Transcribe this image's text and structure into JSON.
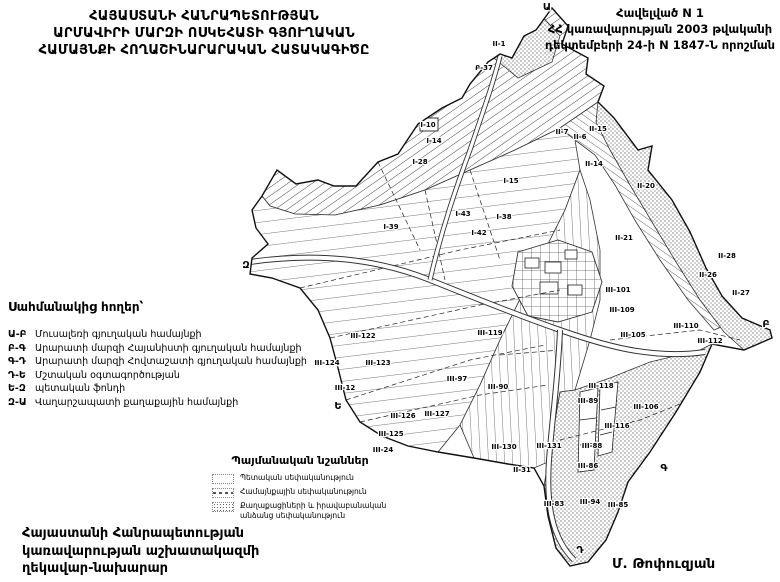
{
  "header": {
    "title_lines": [
      "ՀԱՅԱՍՏԱՆԻ ՀԱՆՐԱՊԵՏՈՒԹՅԱՆ",
      "ԱՐՄԱՎԻՐԻ ՄԱՐԶԻ ՈՍԿԵՀԱՏԻ ԳՅՈՒՂԱԿԱՆ",
      "ՀԱՄԱՅՆՔԻ ՀՈՂԱՇԻՆԱՐԱՐԱԿԱՆ ՀԱՏԱԿԱԳԻԾԸ"
    ],
    "annex_lines": [
      "Հավելված N 1",
      "ՀՀ կառավարության 2003 թվականի",
      "դեկտեմբերի 24-ի N 1847-Ն որոշման"
    ]
  },
  "border_legend": {
    "heading": "Սահմանակից հողեր՝",
    "items": [
      {
        "code": "Ա-Բ",
        "label": "Մուսալեռի գյուղական համայնքի"
      },
      {
        "code": "Բ-Գ",
        "label": "Արարատի մարզի Հայանիստի գյուղական համայնքի"
      },
      {
        "code": "Գ-Դ",
        "label": "Արարատի մարզի Հովտաշատի գյուղական համայնքի"
      },
      {
        "code": "Դ-Ե",
        "label": "Մշտական օգտագործության"
      },
      {
        "code": "Ե-Զ",
        "label": "պետական ֆոնդի"
      },
      {
        "code": "Զ-Ա",
        "label": "Վաղարշապատի քաղաքային համայնքի"
      }
    ]
  },
  "signs_legend": {
    "heading": "Պայմանական նշաններ",
    "items": [
      {
        "swatch": "state",
        "label": "Պետական սեփականություն"
      },
      {
        "swatch": "community",
        "label": "Համայնքային սեփականություն"
      },
      {
        "swatch": "private",
        "label": "Քաղաքացիների և իրավաբանական անձանց սեփականություն"
      }
    ]
  },
  "footer": {
    "left_lines": [
      "Հայաստանի Հանրապետության",
      "կառավարության աշխատակազմի",
      "ղեկավար-նախարար"
    ],
    "signature": "Մ. Թոփուզյան"
  },
  "map": {
    "ink_color": "#1a1a1a",
    "parcel_labels": [
      {
        "t": "II-1",
        "x": 499,
        "y": 46
      },
      {
        "t": "Բ-37",
        "x": 484,
        "y": 70
      },
      {
        "t": "I-10",
        "x": 428,
        "y": 127
      },
      {
        "t": "I-14",
        "x": 434,
        "y": 143
      },
      {
        "t": "I-28",
        "x": 420,
        "y": 164
      },
      {
        "t": "I-15",
        "x": 511,
        "y": 183
      },
      {
        "t": "I-43",
        "x": 463,
        "y": 216
      },
      {
        "t": "I-38",
        "x": 504,
        "y": 219
      },
      {
        "t": "I-42",
        "x": 479,
        "y": 235
      },
      {
        "t": "I-39",
        "x": 391,
        "y": 229
      },
      {
        "t": "II-7",
        "x": 562,
        "y": 134
      },
      {
        "t": "II-6",
        "x": 580,
        "y": 139
      },
      {
        "t": "II-15",
        "x": 598,
        "y": 131
      },
      {
        "t": "II-14",
        "x": 594,
        "y": 166
      },
      {
        "t": "II-20",
        "x": 646,
        "y": 188
      },
      {
        "t": "II-21",
        "x": 624,
        "y": 240
      },
      {
        "t": "II-28",
        "x": 727,
        "y": 258
      },
      {
        "t": "II-26",
        "x": 708,
        "y": 277
      },
      {
        "t": "II-27",
        "x": 741,
        "y": 295
      },
      {
        "t": "III-101",
        "x": 618,
        "y": 292
      },
      {
        "t": "III-109",
        "x": 622,
        "y": 312
      },
      {
        "t": "III-110",
        "x": 686,
        "y": 328
      },
      {
        "t": "III-112",
        "x": 710,
        "y": 343
      },
      {
        "t": "III-105",
        "x": 633,
        "y": 337
      },
      {
        "t": "III-119",
        "x": 490,
        "y": 335
      },
      {
        "t": "III-122",
        "x": 363,
        "y": 338
      },
      {
        "t": "III-123",
        "x": 378,
        "y": 365
      },
      {
        "t": "III-124",
        "x": 327,
        "y": 365
      },
      {
        "t": "III-12",
        "x": 345,
        "y": 390
      },
      {
        "t": "III-97",
        "x": 457,
        "y": 381
      },
      {
        "t": "III-90",
        "x": 498,
        "y": 389
      },
      {
        "t": "III-118",
        "x": 601,
        "y": 388
      },
      {
        "t": "III-116",
        "x": 617,
        "y": 428
      },
      {
        "t": "III-89",
        "x": 588,
        "y": 403
      },
      {
        "t": "III-106",
        "x": 646,
        "y": 409
      },
      {
        "t": "III-88",
        "x": 592,
        "y": 448
      },
      {
        "t": "III-86",
        "x": 588,
        "y": 468
      },
      {
        "t": "III-130",
        "x": 504,
        "y": 449
      },
      {
        "t": "III-131",
        "x": 549,
        "y": 448
      },
      {
        "t": "II-31",
        "x": 522,
        "y": 472
      },
      {
        "t": "III-83",
        "x": 554,
        "y": 506
      },
      {
        "t": "III-94",
        "x": 590,
        "y": 504
      },
      {
        "t": "III-85",
        "x": 618,
        "y": 507
      },
      {
        "t": "III-126",
        "x": 403,
        "y": 418
      },
      {
        "t": "III-127",
        "x": 437,
        "y": 416
      },
      {
        "t": "III-125",
        "x": 391,
        "y": 436
      },
      {
        "t": "III-24",
        "x": 383,
        "y": 452
      }
    ],
    "boundary_points": [
      {
        "t": "Ա",
        "x": 547,
        "y": 10
      },
      {
        "t": "Բ",
        "x": 766,
        "y": 327
      },
      {
        "t": "Գ",
        "x": 664,
        "y": 471
      },
      {
        "t": "Դ",
        "x": 580,
        "y": 553
      },
      {
        "t": "Ե",
        "x": 338,
        "y": 409
      },
      {
        "t": "Զ",
        "x": 246,
        "y": 268
      }
    ]
  }
}
